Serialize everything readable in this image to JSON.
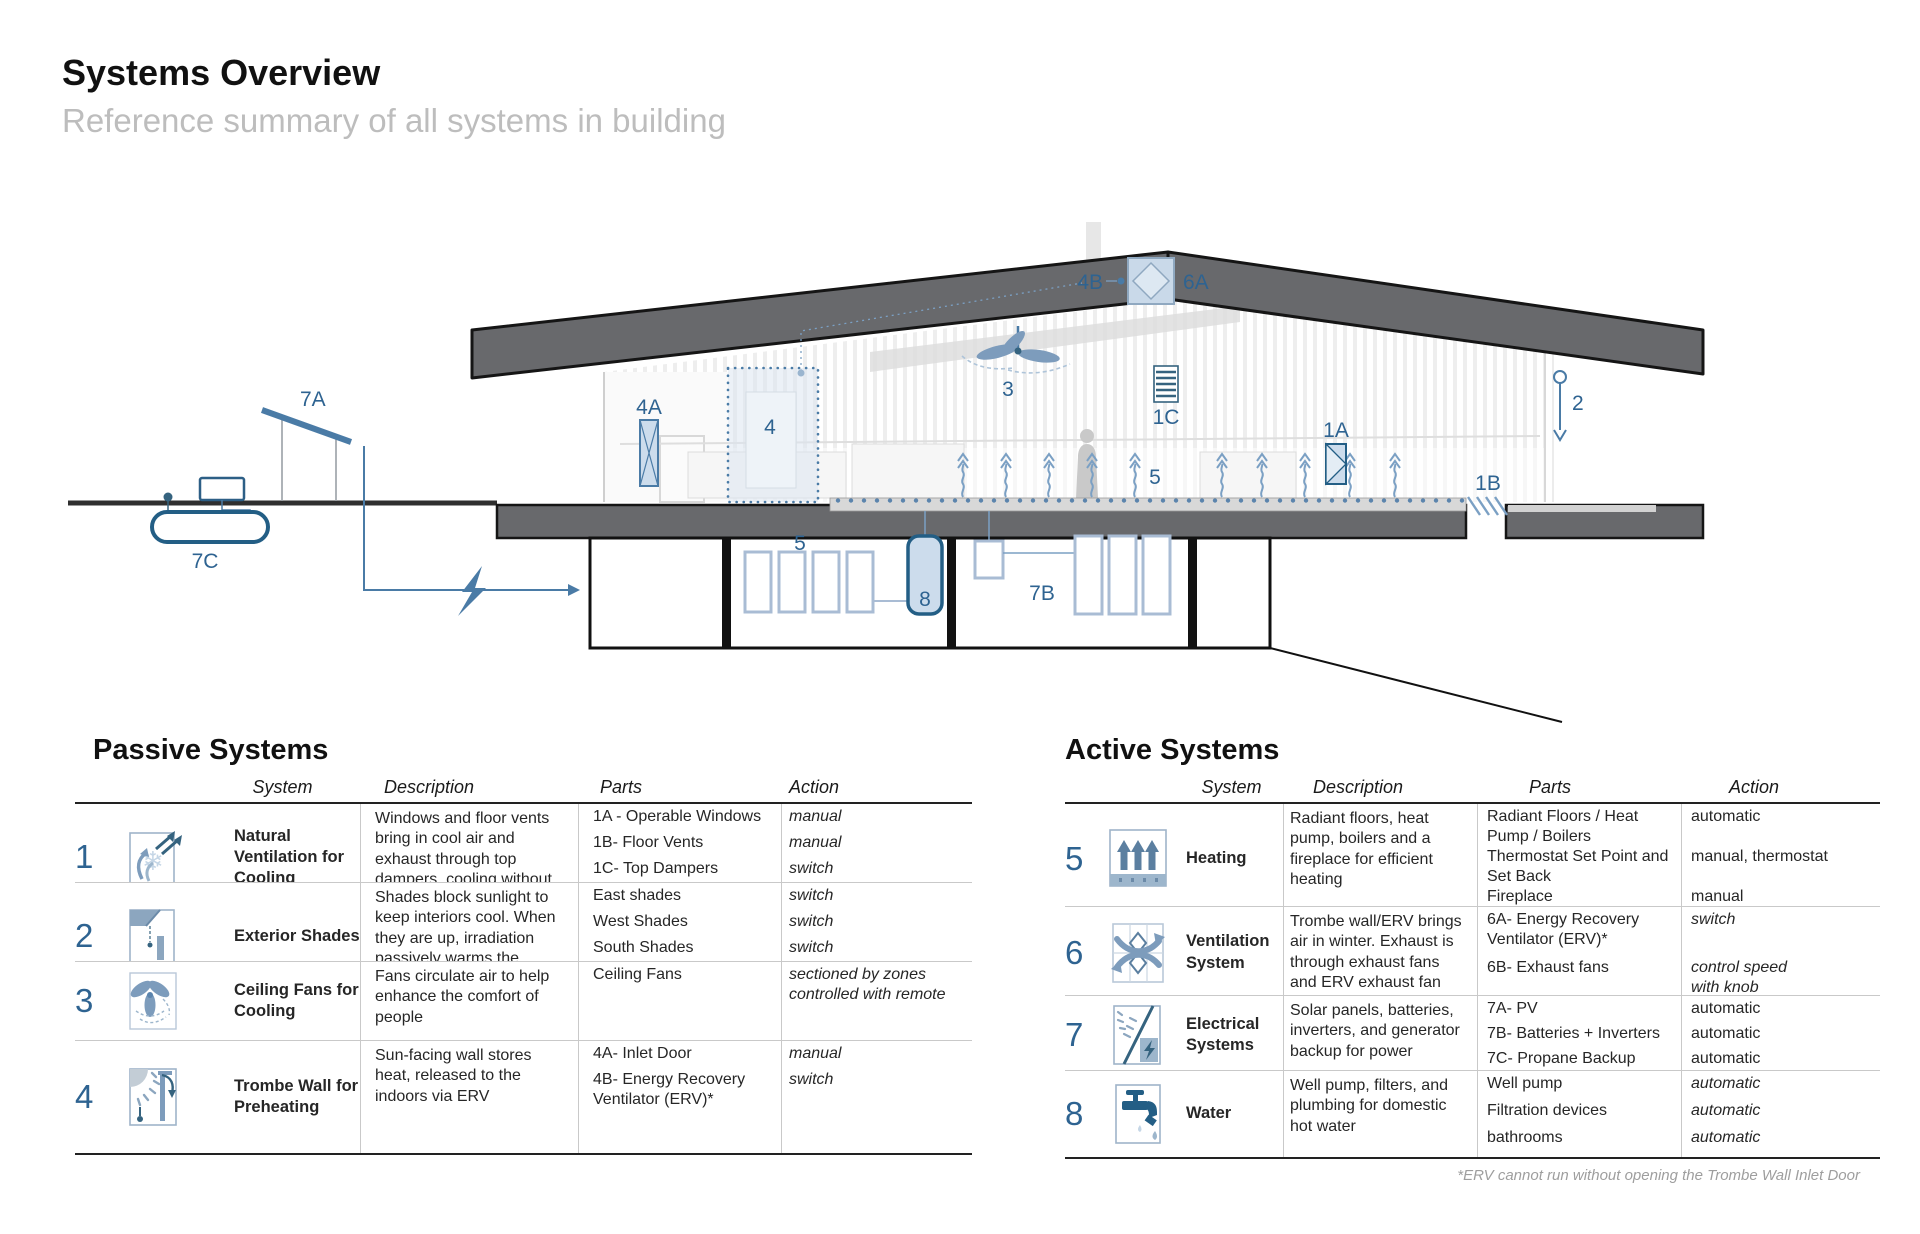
{
  "page": {
    "title": "Systems Overview",
    "subtitle": "Reference summary of all systems in building"
  },
  "colors": {
    "accent_blue": "#2e6391",
    "mid_blue": "#4a7ba6",
    "pale_blue": "#ccdcec",
    "roof_gray": "#68696c"
  },
  "diagram": {
    "labels": {
      "solar_panel": "7A",
      "propane_tank": "7C",
      "trombe_inlet": "4A",
      "trombe_wall": "4",
      "erv_roof_4b": "4B",
      "erv_roof_6a": "6A",
      "ceiling_fan": "3",
      "top_damper": "1C",
      "radiant_room": "5",
      "window": "1A",
      "floor_vent": "1B",
      "shade": "2",
      "boilers": "5",
      "water_tank": "8",
      "batteries": "7B"
    }
  },
  "passive": {
    "title": "Passive Systems",
    "headers": {
      "system": "System",
      "description": "Description",
      "parts": "Parts",
      "action": "Action"
    },
    "rows": [
      {
        "num": "1",
        "system": "Natural Ventilation for Cooling",
        "description": "Windows and floor vents bring in cool air and exhaust through top dampers, cooling without AC.",
        "parts": [
          {
            "name": "1A - Operable Windows",
            "action": "manual"
          },
          {
            "name": "1B- Floor Vents",
            "action": "manual"
          },
          {
            "name": "1C- Top Dampers",
            "action": "switch"
          }
        ]
      },
      {
        "num": "2",
        "system": "Exterior Shades",
        "description": "Shades block sunlight to keep interiors cool. When they are up, irradiation passively warms the space",
        "parts": [
          {
            "name": "East shades",
            "action": "switch"
          },
          {
            "name": "West Shades",
            "action": "switch"
          },
          {
            "name": "South Shades",
            "action": "switch"
          }
        ]
      },
      {
        "num": "3",
        "system": "Ceiling Fans for Cooling",
        "description": "Fans circulate air to help enhance the comfort of people",
        "parts": [
          {
            "name": "Ceiling Fans",
            "action": "sectioned by zones controlled with remote"
          }
        ]
      },
      {
        "num": "4",
        "system": "Trombe Wall for Preheating",
        "description": "Sun-facing wall stores heat, released to the indoors via ERV",
        "parts": [
          {
            "name": "4A- Inlet Door",
            "action": "manual"
          },
          {
            "name": "4B- Energy Recovery Ventilator (ERV)*",
            "action": "switch"
          }
        ]
      }
    ]
  },
  "active": {
    "title": "Active Systems",
    "headers": {
      "system": "System",
      "description": "Description",
      "parts": "Parts",
      "action": "Action"
    },
    "rows": [
      {
        "num": "5",
        "system": "Heating",
        "description": "Radiant floors, heat pump, boilers and a fireplace for efficient heating",
        "parts": [
          {
            "name": "Radiant Floors / Heat Pump / Boilers",
            "action": "automatic"
          },
          {
            "name": "Thermostat Set Point and Set Back",
            "action": "manual, thermostat"
          },
          {
            "name": "Fireplace",
            "action": "manual"
          }
        ]
      },
      {
        "num": "6",
        "system": "Ventilation System",
        "description": "Trombe wall/ERV brings air in winter. Exhaust is through exhaust fans and ERV exhaust fan",
        "parts": [
          {
            "name": "6A- Energy Recovery Ventilator (ERV)*",
            "action": "switch"
          },
          {
            "name": "6B- Exhaust fans",
            "action": "control speed\nwith knob"
          }
        ]
      },
      {
        "num": "7",
        "system": "Electrical Systems",
        "description": "Solar panels, batteries, inverters, and generator backup for power",
        "parts": [
          {
            "name": "7A- PV",
            "action": "automatic"
          },
          {
            "name": "7B- Batteries + Inverters",
            "action": "automatic"
          },
          {
            "name": "7C- Propane Backup",
            "action": "automatic"
          }
        ]
      },
      {
        "num": "8",
        "system": "Water",
        "description": "Well pump, filters, and plumbing for domestic hot water",
        "parts": [
          {
            "name": "Well pump",
            "action": "automatic"
          },
          {
            "name": "Filtration devices",
            "action": "automatic"
          },
          {
            "name": "bathrooms",
            "action": "automatic"
          }
        ]
      }
    ],
    "footnote": "*ERV cannot run without opening the Trombe Wall Inlet Door"
  }
}
